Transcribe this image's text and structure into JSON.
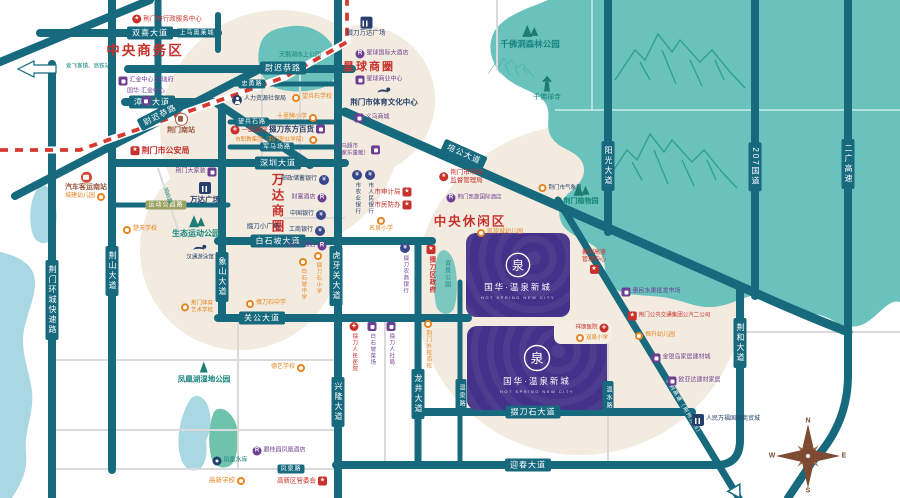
{
  "palette": {
    "road": "#17697e",
    "forest": "#69c2bb",
    "forest_dark": "#1d7d74",
    "beige": "#f3ebdf",
    "water": "#a9d7e2",
    "project_purple": "#443189",
    "red": "#c8302b",
    "orange": "#e6841f",
    "purple": "#6c3f92",
    "navy": "#27406b",
    "brown": "#9c5a41",
    "railway": "#d63a2f"
  },
  "project": {
    "name": "国华·温泉新城",
    "latin": "HOT SPRING NEW CITY",
    "logo_char": "泉"
  },
  "compass": {
    "n": "N",
    "e": "E",
    "s": "S",
    "w": "W"
  },
  "map": {
    "zones": [
      {
        "t": "中央商务区",
        "x": 145,
        "y": 49,
        "fs": 13.5
      },
      {
        "t": "星球商圈",
        "x": 369,
        "y": 66,
        "fs": 11
      },
      {
        "t": "中央休闲区",
        "x": 470,
        "y": 220,
        "fs": 12.5
      },
      {
        "t": "万达商圈",
        "x": 277,
        "y": 204,
        "fs": 12.5,
        "vert": 1
      }
    ],
    "road_badges": [
      {
        "t": "双喜大道",
        "x": 150,
        "y": 33
      },
      {
        "t": "上马奥莱城",
        "x": 197,
        "y": 33,
        "sm": 1
      },
      {
        "t": "漳河大道",
        "x": 152,
        "y": 102
      },
      {
        "t": "尉迟恭路",
        "x": 160,
        "y": 115,
        "rot": -27
      },
      {
        "t": "尉迟恭路",
        "x": 283,
        "y": 68
      },
      {
        "t": "忠勇路",
        "x": 252,
        "y": 84,
        "sm": 1
      },
      {
        "t": "望兵石路",
        "x": 252,
        "y": 122,
        "sm": 1
      },
      {
        "t": "军马场路",
        "x": 277,
        "y": 147,
        "sm": 1
      },
      {
        "t": "深圳大道",
        "x": 278,
        "y": 163
      },
      {
        "t": "运动公园路",
        "x": 166,
        "y": 205,
        "sm": 1,
        "olive": 1
      },
      {
        "t": "白石坡大道",
        "x": 278,
        "y": 241
      },
      {
        "t": "关公大道",
        "x": 262,
        "y": 318
      },
      {
        "t": "荆山大道",
        "x": 112,
        "y": 271,
        "v": 1
      },
      {
        "t": "象山大道",
        "x": 222,
        "y": 277,
        "v": 1
      },
      {
        "t": "荆门环城快速路",
        "x": 52,
        "y": 300,
        "v": 1
      },
      {
        "t": "虎牙关大道",
        "x": 336,
        "y": 276,
        "v": 1
      },
      {
        "t": "兴隆大道",
        "x": 338,
        "y": 402,
        "v": 1
      },
      {
        "t": "龙井大道",
        "x": 418,
        "y": 394,
        "v": 1
      },
      {
        "t": "温泉路",
        "x": 461,
        "y": 396,
        "v": 1,
        "sm": 1
      },
      {
        "t": "掇刀石大道",
        "x": 533,
        "y": 412
      },
      {
        "t": "迎春大道",
        "x": 528,
        "y": 465
      },
      {
        "t": "凤泉路",
        "x": 291,
        "y": 469,
        "sm": 1
      },
      {
        "t": "培公大道",
        "x": 464,
        "y": 154,
        "rot": 24
      },
      {
        "t": "阳光大道",
        "x": 608,
        "y": 166,
        "v": 1
      },
      {
        "t": "207国道",
        "x": 755,
        "y": 167,
        "v": 1
      },
      {
        "t": "二广高速",
        "x": 848,
        "y": 164,
        "v": 1
      },
      {
        "t": "荆和大道",
        "x": 740,
        "y": 343,
        "v": 1
      },
      {
        "t": "温水路",
        "x": 608,
        "y": 398,
        "v": 1,
        "sm": 1
      },
      {
        "t": "襄荆高速（荆州方向）",
        "x": 683,
        "y": 408,
        "rot": 59,
        "onroad": 1
      }
    ],
    "pois": [
      {
        "l": "荆门市行政服务中心",
        "x": 167,
        "y": 19,
        "ic": "circle-star",
        "c": "red",
        "lo": "it",
        "fs": 6.5
      },
      {
        "l": "汇金中心·金瑞府",
        "x": 146,
        "y": 81,
        "ic": "shop",
        "c": "pur",
        "lo": "it",
        "fs": 6
      },
      {
        "l": "国华·汇金中心",
        "x": 146,
        "y": 97,
        "ic": "shop",
        "c": "pur",
        "lo": "st2",
        "fs": 6
      },
      {
        "l": "荆门南站",
        "x": 181,
        "y": 124,
        "ic": "train",
        "c": "brn",
        "lo": "st",
        "fs": 7,
        "b": 1
      },
      {
        "l": "荆门市公安局",
        "x": 160,
        "y": 151,
        "ic": "star-badge",
        "c": "red",
        "lo": "it",
        "fs": 8,
        "b": 1
      },
      {
        "l": "爱飞客镇、高铁站",
        "x": 88,
        "y": 67,
        "c": "tea",
        "lo": "tx",
        "fs": 5.5
      },
      {
        "l": "汽车客运南站",
        "x": 86,
        "y": 182,
        "ic": "bus",
        "c": "brn",
        "lo": "st",
        "fs": 7,
        "b": 1
      },
      {
        "l": "城建幼儿园",
        "x": 85,
        "y": 197,
        "ic": "orange",
        "c": "org",
        "lo": "ti",
        "fs": 6
      },
      {
        "l": "楚天学校",
        "x": 140,
        "y": 230,
        "ic": "orange",
        "c": "org",
        "lo": "it",
        "fs": 6
      },
      {
        "l": "生态运动公园",
        "x": 196,
        "y": 226,
        "ic": "trees",
        "c": "tea",
        "lo": "st",
        "fs": 8,
        "b": 1
      },
      {
        "l": "汉通游泳馆",
        "x": 200,
        "y": 253,
        "ic": "swim",
        "c": "nvy",
        "lo": "st",
        "fs": 5.5
      },
      {
        "l": "荆门大家装",
        "x": 196,
        "y": 172,
        "ic": "shop",
        "c": "pur",
        "lo": "ti",
        "fs": 6
      },
      {
        "l": "万达广场",
        "x": 205,
        "y": 193,
        "ic": "building",
        "c": "nvy",
        "lo": "st",
        "fs": 7.5,
        "b": 1
      },
      {
        "l": "掇刀小广场",
        "x": 263,
        "y": 227,
        "c": "nvy",
        "lo": "tx",
        "fs": 6.5
      },
      {
        "l": "响岭路",
        "x": 167,
        "y": 196,
        "c": "tea",
        "lo": "tx",
        "fs": 5.5,
        "rot": 72
      },
      {
        "l": "人力资源社保局",
        "x": 259,
        "y": 100,
        "ic": "person",
        "c": "nvy",
        "lo": "it",
        "fs": 6
      },
      {
        "l": "望兵石学校",
        "x": 312,
        "y": 98,
        "ic": "orange",
        "c": "org",
        "lo": "it",
        "fs": 6
      },
      {
        "l": "十里牌小学",
        "x": 297,
        "y": 118,
        "ic": "orange",
        "c": "org",
        "lo": "ti",
        "fs": 6
      },
      {
        "l": "一医南院",
        "x": 249,
        "y": 130,
        "ic": "cross",
        "c": "red",
        "lo": "it",
        "fs": 6.5
      },
      {
        "l": "掇刀东方百货",
        "x": 297,
        "y": 129,
        "ic": "shop",
        "c": "nvy",
        "lo": "ti",
        "fs": 7.5,
        "b": 1
      },
      {
        "l": "市职教集团（荆门职业学院）",
        "x": 276,
        "y": 140,
        "ic": "orange",
        "c": "org",
        "lo": "ti",
        "fs": 5.5
      },
      {
        "l": "邮政储蓄银行",
        "x": 305,
        "y": 180,
        "ic": "bank",
        "c": "nvy",
        "lo": "ti",
        "fs": 6
      },
      {
        "l": "财富酒店",
        "x": 309,
        "y": 198,
        "ic": "hotel",
        "c": "pur",
        "lo": "ti",
        "fs": 6
      },
      {
        "l": "中国银行",
        "x": 308,
        "y": 215,
        "ic": "bank",
        "c": "nvy",
        "lo": "ti",
        "fs": 6
      },
      {
        "l": "工商银行",
        "x": 307,
        "y": 231,
        "ic": "bank",
        "c": "nvy",
        "lo": "ti",
        "fs": 6
      },
      {
        "l": "金王子酒店",
        "x": 306,
        "y": 246,
        "ic": "hotel",
        "c": "pur",
        "lo": "ti",
        "fs": 6
      },
      {
        "l": "市农业银行",
        "x": 357,
        "y": 170,
        "ic": "bank",
        "c": "nvy",
        "lo": "v",
        "fs": 5.5
      },
      {
        "l": "市人民银行",
        "x": 370,
        "y": 170,
        "ic": "bank",
        "c": "nvy",
        "lo": "v",
        "fs": 5.5
      },
      {
        "l": "市审计局",
        "x": 393,
        "y": 192,
        "ic": "star-badge",
        "c": "red",
        "lo": "ti",
        "fs": 6.5
      },
      {
        "l": "市民防办",
        "x": 393,
        "y": 205,
        "ic": "star-badge",
        "c": "red",
        "lo": "ti",
        "fs": 6.5
      },
      {
        "l": "名泉小学",
        "x": 381,
        "y": 225,
        "ic": "orange",
        "c": "org",
        "lo": "st",
        "fs": 6
      },
      {
        "l": "掇刀农商银行",
        "x": 405,
        "y": 243,
        "ic": "bank",
        "c": "pur",
        "lo": "v",
        "fs": 5.5
      },
      {
        "l": "白石坡中学",
        "x": 303,
        "y": 258,
        "ic": "orange",
        "c": "org",
        "lo": "v",
        "fs": 5.5
      },
      {
        "l": "掇刀石小学",
        "x": 318,
        "y": 252,
        "ic": "orange",
        "c": "org",
        "lo": "v",
        "fs": 5.5
      },
      {
        "lines": [
          "金马超市",
          "（家乐量贩）"
        ],
        "x": 358,
        "y": 150,
        "ic": "shop",
        "c": "pur",
        "lo": "ti",
        "fs": 5.5
      },
      {
        "l": "掇刀万达广场",
        "x": 366,
        "y": 27,
        "ic": "building",
        "c": "nvy",
        "lo": "st",
        "fs": 6.5
      },
      {
        "l": "星球国际大酒店",
        "x": 382,
        "y": 54,
        "ic": "hotel",
        "c": "pur",
        "lo": "it",
        "fs": 6
      },
      {
        "l": "星球商业中心",
        "x": 379,
        "y": 80,
        "ic": "shop",
        "c": "pur",
        "lo": "it",
        "fs": 6
      },
      {
        "l": "荆门市体育文化中心",
        "x": 384,
        "y": 97,
        "ic": "swim",
        "c": "nvy",
        "lo": "st",
        "fs": 7.5,
        "b": 1
      },
      {
        "l": "义乌商城",
        "x": 372,
        "y": 118,
        "ic": "shop",
        "c": "pur",
        "lo": "it",
        "fs": 6
      },
      {
        "lines": [
          "荆门市市场",
          "监督管理局"
        ],
        "x": 461,
        "y": 177,
        "ic": "circle-star",
        "c": "red",
        "lo": "it",
        "fs": 6.5
      },
      {
        "l": "荆门凯旋国际酒店",
        "x": 474,
        "y": 198,
        "ic": "hotel",
        "c": "pur",
        "lo": "it",
        "fs": 5.5
      },
      {
        "l": "凯旋城幼儿园",
        "x": 500,
        "y": 233,
        "ic": "orange",
        "c": "org",
        "lo": "it",
        "fs": 6
      },
      {
        "l": "荆门市气象局",
        "x": 560,
        "y": 188,
        "ic": "dotcircle",
        "c": "nvy",
        "lo": "it",
        "fs": 5.5
      },
      {
        "l": "荆门植物园",
        "x": 581,
        "y": 194,
        "ic": "trees",
        "c": "tea",
        "lo": "st",
        "fs": 7,
        "b": 1
      },
      {
        "l": "惠民水果批发市场",
        "x": 651,
        "y": 292,
        "ic": "shop",
        "c": "pur",
        "lo": "it",
        "fs": 6
      },
      {
        "lines": [
          "襄荆高速",
          "管理中心"
        ],
        "x": 594,
        "y": 262,
        "ic": "star-badge",
        "c": "red",
        "lo": "st2",
        "fs": 6
      },
      {
        "l": "荆门公共交通集团公汽二公司",
        "x": 669,
        "y": 316,
        "ic": "star-badge",
        "c": "red",
        "lo": "it",
        "fs": 5.5
      },
      {
        "l": "祥康医院",
        "x": 592,
        "y": 328,
        "ic": "cross",
        "c": "red",
        "lo": "ti",
        "fs": 5.5
      },
      {
        "l": "双泉小学",
        "x": 592,
        "y": 338,
        "ic": "orange",
        "c": "org",
        "lo": "it",
        "fs": 5.5
      },
      {
        "l": "恒升幼儿园",
        "x": 655,
        "y": 336,
        "ic": "orange",
        "c": "org",
        "lo": "it",
        "fs": 6
      },
      {
        "l": "金银岛家居建材城",
        "x": 681,
        "y": 358,
        "ic": "shop",
        "c": "pur",
        "lo": "it",
        "fs": 6
      },
      {
        "l": "欧亚达建材家居",
        "x": 694,
        "y": 381,
        "ic": "shop",
        "c": "pur",
        "lo": "it",
        "fs": 6
      },
      {
        "l": "人民万福国际商贸城",
        "x": 726,
        "y": 420,
        "ic": "building",
        "c": "nvy",
        "lo": "it",
        "fs": 6
      },
      {
        "l": "掇刀区政府",
        "x": 431,
        "y": 245,
        "ic": "star-badge",
        "c": "red",
        "lo": "v",
        "fs": 6.5,
        "b": 1
      },
      {
        "l": "荆门外校南校",
        "x": 428,
        "y": 320,
        "ic": "orange",
        "c": "org",
        "lo": "v",
        "fs": 5.5
      },
      {
        "l": "掇刀人民医院",
        "x": 354,
        "y": 322,
        "ic": "cross",
        "c": "red",
        "lo": "v",
        "fs": 5.5
      },
      {
        "l": "白石坡菜场",
        "x": 372,
        "y": 322,
        "ic": "shop",
        "c": "pur",
        "lo": "v",
        "fs": 5.5
      },
      {
        "l": "掇刀人社局",
        "x": 391,
        "y": 322,
        "ic": "shop",
        "c": "pur",
        "lo": "v",
        "fs": 5.5
      },
      {
        "l": "双泉公园",
        "x": 446,
        "y": 260,
        "c": "tea",
        "lo": "vt",
        "fs": 6
      },
      {
        "lines": [
          "荆门体育",
          "艺术学校"
        ],
        "x": 197,
        "y": 307,
        "ic": "orange",
        "c": "org",
        "lo": "it",
        "fs": 5.5
      },
      {
        "l": "掇刀石中学",
        "x": 266,
        "y": 304,
        "ic": "orange",
        "c": "org",
        "lo": "it",
        "fs": 6
      },
      {
        "l": "德艺学校",
        "x": 288,
        "y": 368,
        "ic": "orange",
        "c": "org",
        "lo": "ti",
        "fs": 6
      },
      {
        "l": "凤凰湖湿地公园",
        "x": 204,
        "y": 372,
        "ic": "tree1",
        "c": "tea",
        "lo": "st",
        "fs": 7.5,
        "b": 1
      },
      {
        "l": "凤凰水库",
        "x": 230,
        "y": 461,
        "ic": "dot",
        "c": "tea",
        "lo": "it",
        "fs": 6
      },
      {
        "l": "碧桂园凤凰酒店",
        "x": 279,
        "y": 451,
        "ic": "hotel",
        "c": "pur",
        "lo": "it",
        "fs": 6
      },
      {
        "l": "高新学校",
        "x": 227,
        "y": 481,
        "ic": "orange",
        "c": "org",
        "lo": "ti",
        "fs": 6.5
      },
      {
        "l": "高新区管委会",
        "x": 302,
        "y": 481,
        "ic": "star-badge",
        "c": "red",
        "lo": "ti",
        "fs": 6.5
      },
      {
        "l": "千佛洞森林公园",
        "x": 530,
        "y": 36,
        "ic": "trees",
        "c": "tea",
        "lo": "st",
        "fs": 8.5,
        "b": 1
      },
      {
        "l": "千佛禅寺",
        "x": 547,
        "y": 89,
        "ic": "pagoda",
        "c": "tea",
        "lo": "st",
        "fs": 7
      },
      {
        "l": "天鹅湖水上公园",
        "x": 300,
        "y": 56,
        "c": "tea",
        "lo": "tx",
        "fs": 6
      }
    ]
  }
}
